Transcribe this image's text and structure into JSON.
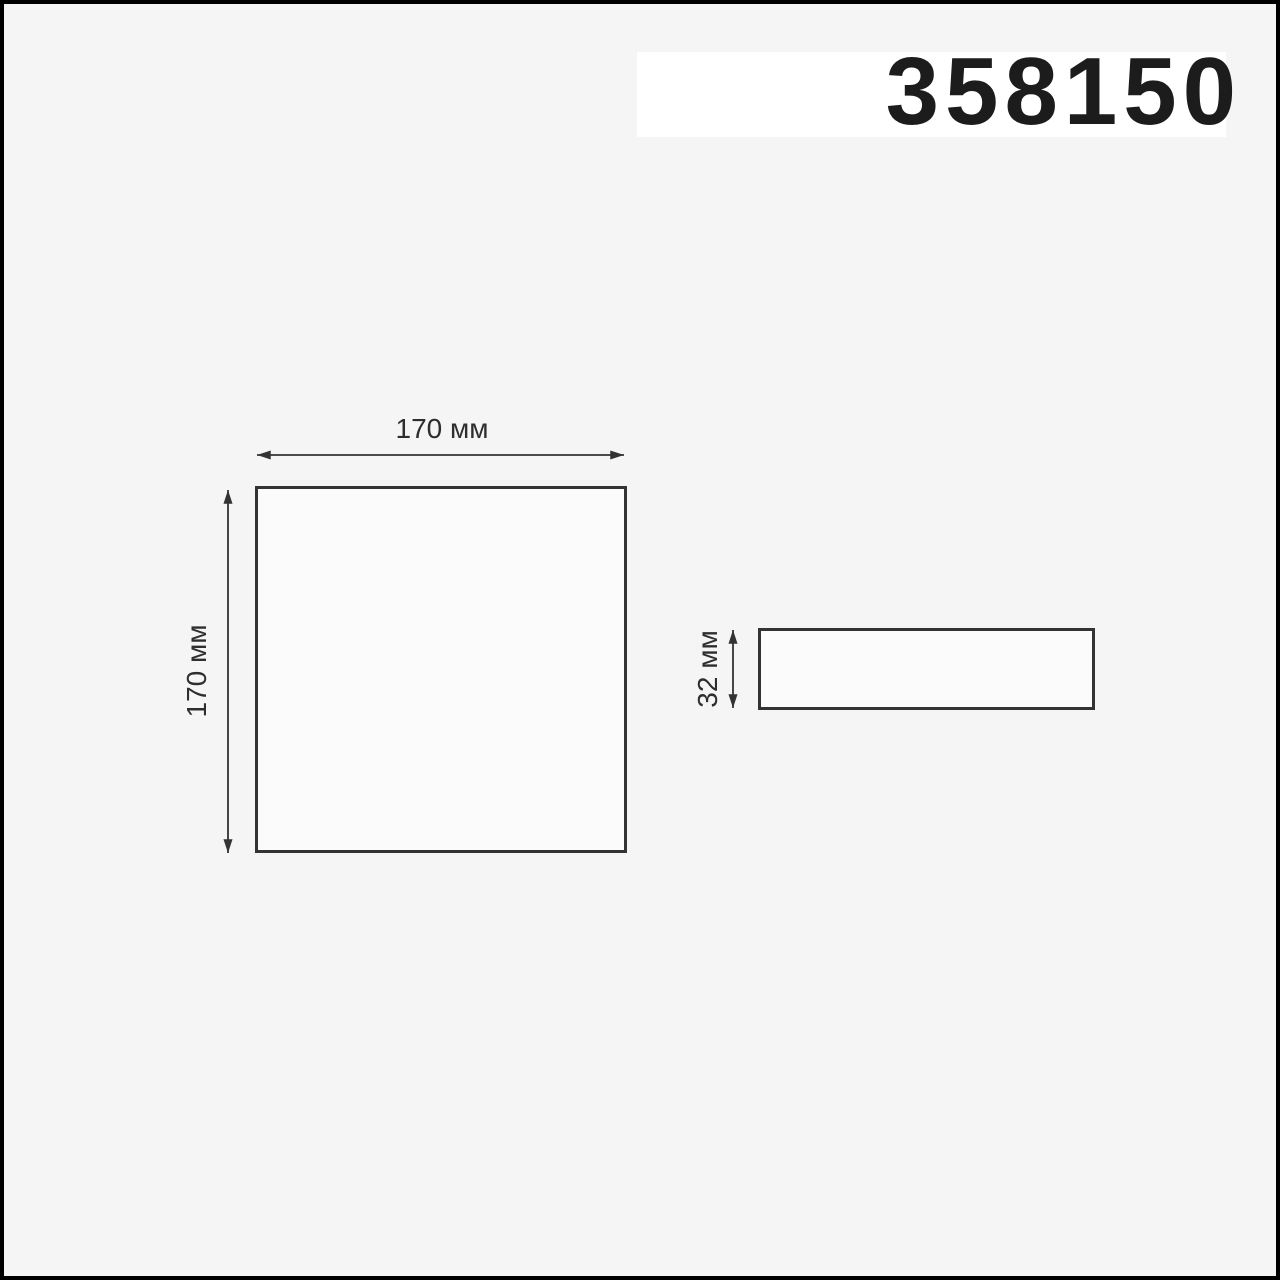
{
  "product": {
    "code": "358150"
  },
  "views": {
    "front": {
      "width_label": "170 мм",
      "height_label": "170 мм"
    },
    "side": {
      "thickness_label": "32 мм"
    }
  },
  "colors": {
    "background": "#f5f5f5",
    "band": "#ffffff",
    "frame": "#000000",
    "line": "#333333",
    "label_text": "#2e2e2e",
    "code_text": "#1c1c1c",
    "shape_fill": "#fbfbfb"
  }
}
